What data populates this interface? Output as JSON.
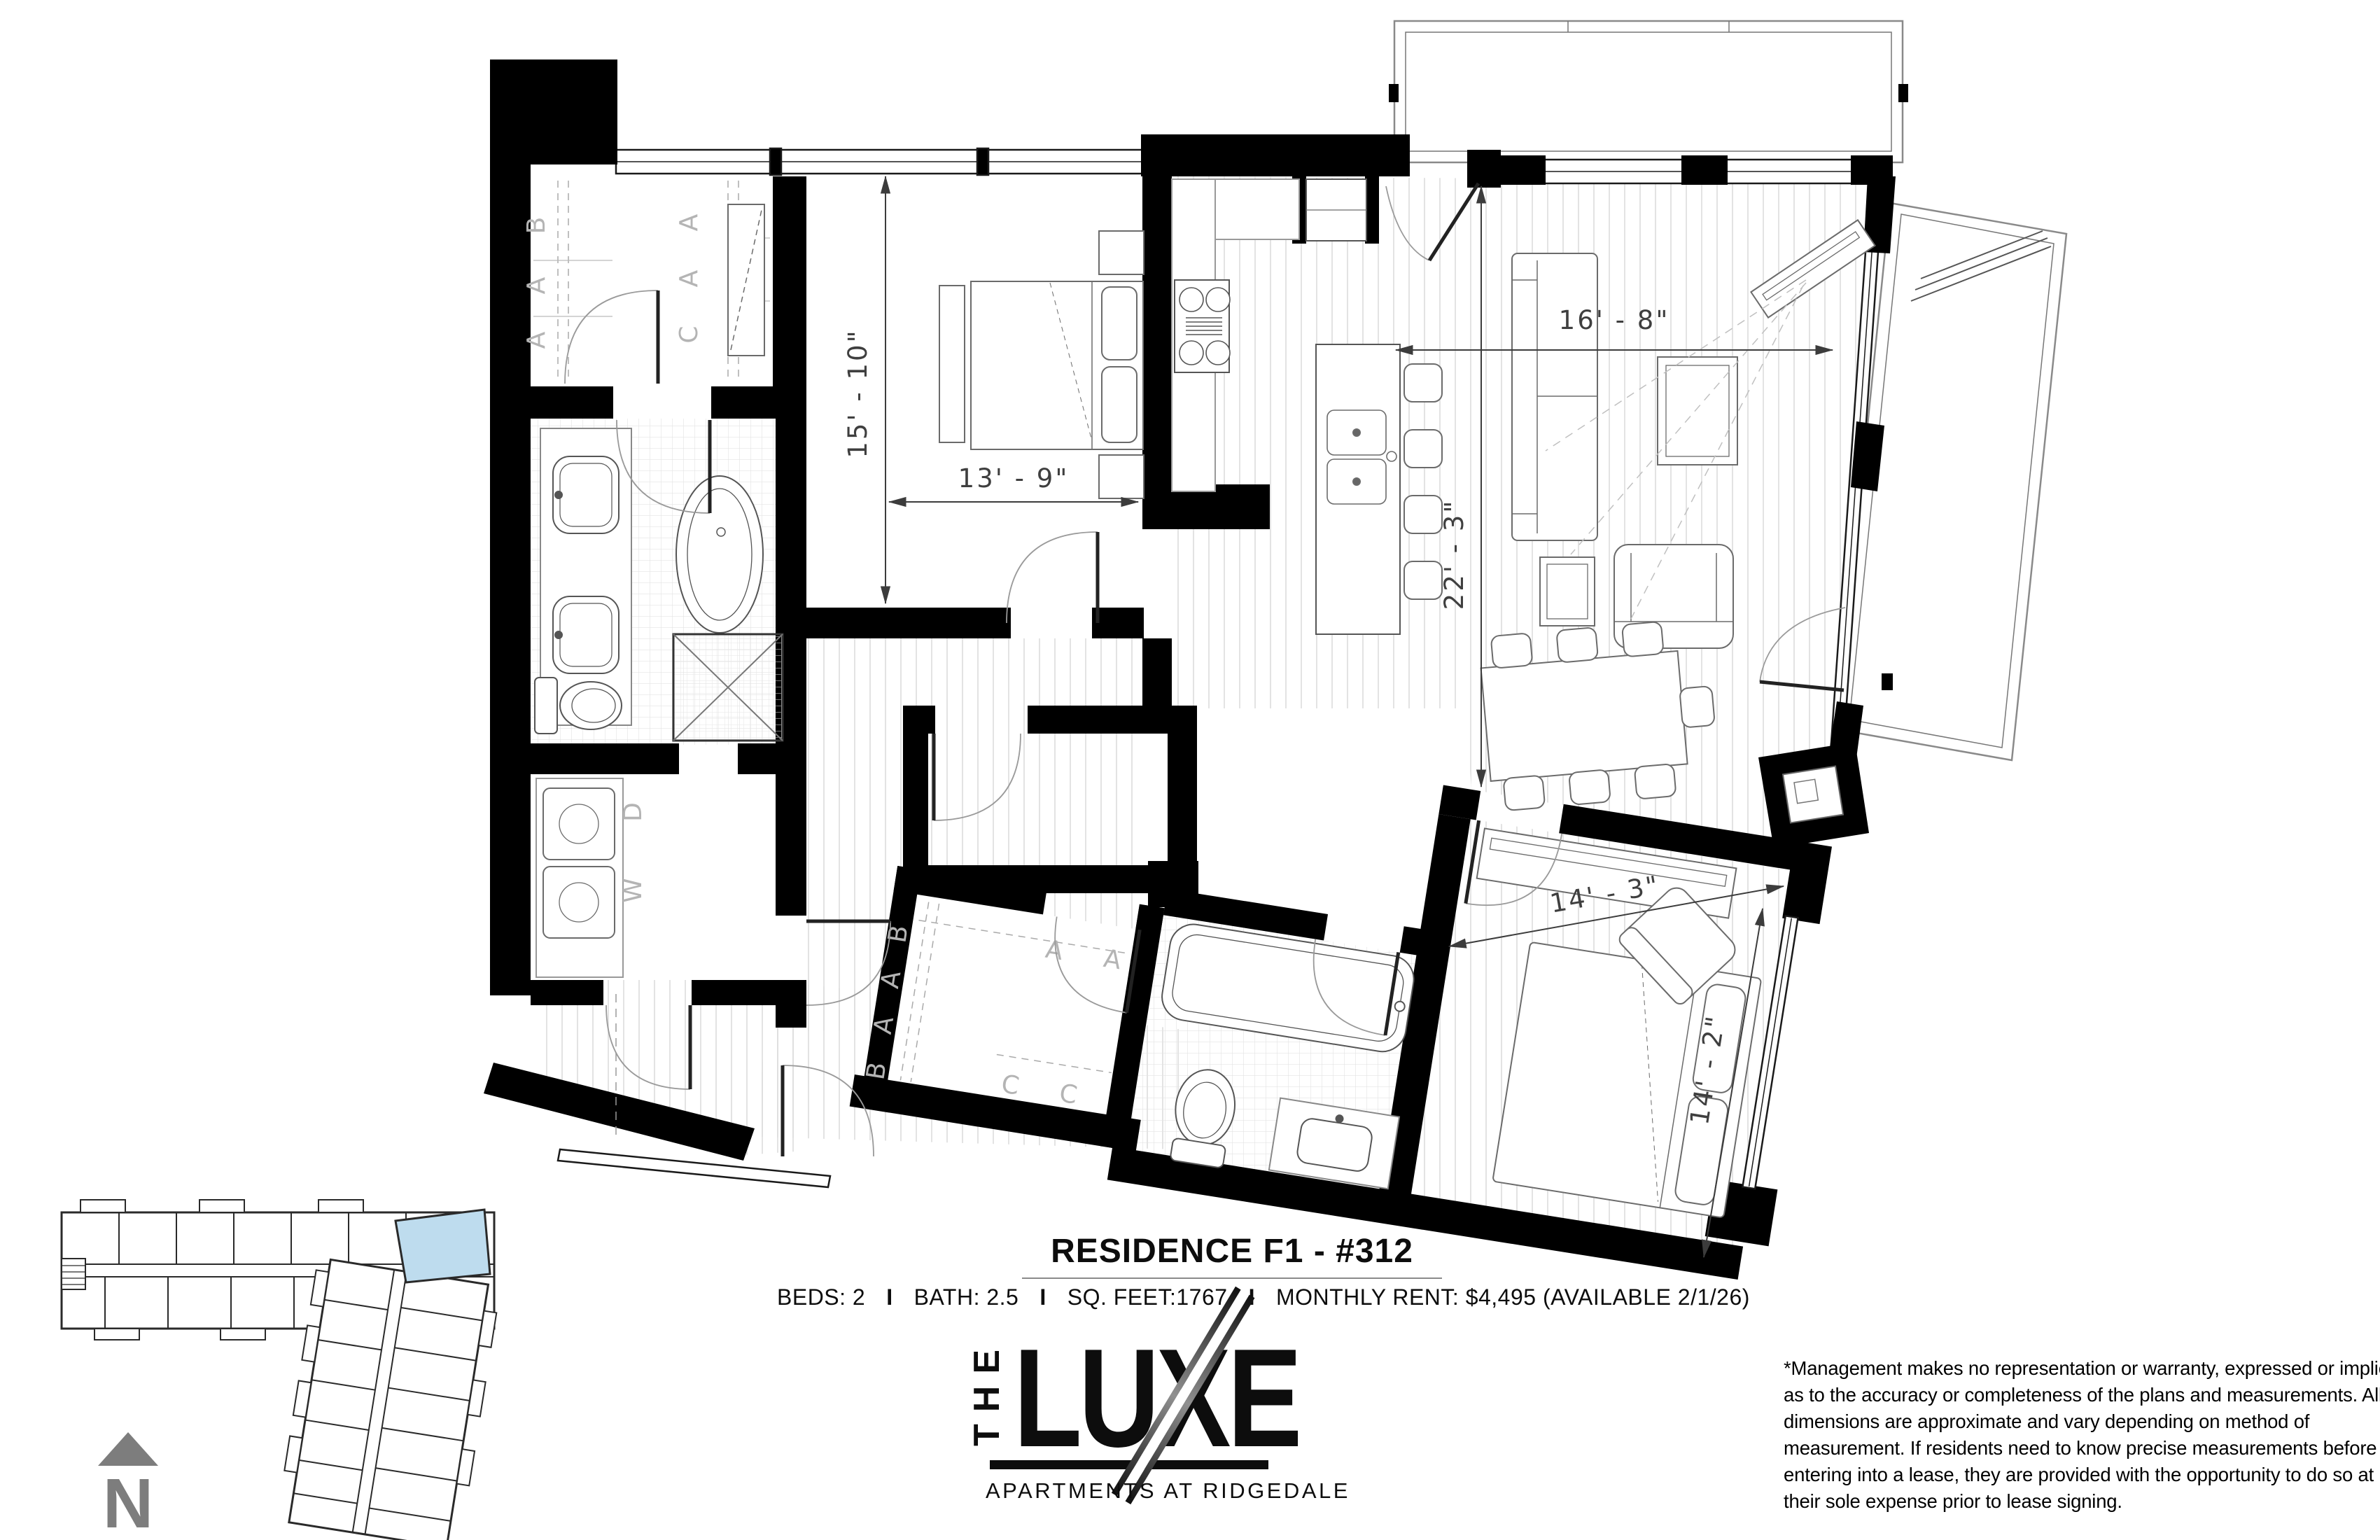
{
  "floor_plan": {
    "dimensions": {
      "bedroom1_v": "15' - 10\"",
      "bedroom1_h": "13' - 9\"",
      "living_h": "16' - 8\"",
      "living_v": "22' - 3\"",
      "bedroom2_h": "14' - 3\"",
      "bedroom2_v": "14' - 2\""
    },
    "closet1": {
      "left": [
        "B",
        "A",
        "A"
      ],
      "right": [
        "A",
        "A",
        "C"
      ]
    },
    "closet2": {
      "left": [
        "B",
        "A",
        "A",
        "B"
      ],
      "top": [
        "A",
        "A"
      ],
      "bottom": [
        "C",
        "C"
      ]
    },
    "laundry": {
      "dryer": "D",
      "washer": "W"
    }
  },
  "title_block": {
    "title": "RESIDENCE F1 - #312",
    "specs": {
      "beds": "BEDS: 2",
      "bath": "BATH: 2.5",
      "sqft": "SQ. FEET:1767",
      "rent": "MONTHLY RENT: $4,495 (AVAILABLE 2/1/26)",
      "separator": "I"
    }
  },
  "logo": {
    "the": "THE",
    "name": "LUXE",
    "tagline": "APARTMENTS AT RIDGEDALE"
  },
  "disclaimer": {
    "lines": [
      "*Management makes no representation or warranty, expressed or implied,",
      "as to the accuracy or completeness of the plans and measurements. All",
      "dimensions are approximate and vary depending on method of",
      "measurement. If residents need to know precise measurements before",
      "entering into a lease, they are provided with the opportunity to do so at",
      "their sole expense prior to lease signing."
    ]
  },
  "key_plan": {
    "highlight_color": "#bedcee"
  },
  "north": {
    "label": "N"
  },
  "colors": {
    "wall": "#000000",
    "north_gray": "#7d7d7d",
    "floor_line": "#dcdcdc"
  }
}
